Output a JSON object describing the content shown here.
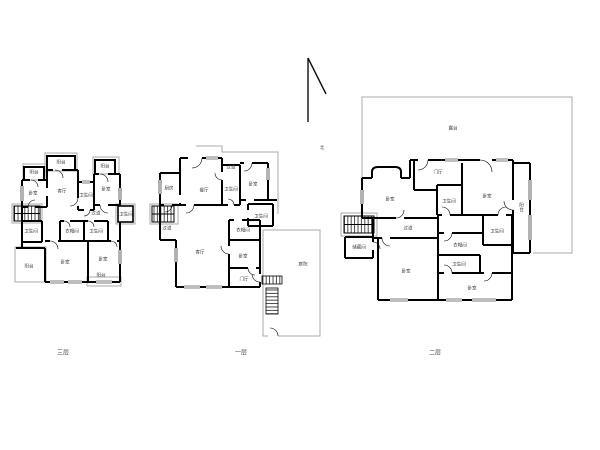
{
  "colors": {
    "wall": "#000000",
    "outline": "#a9a9a9",
    "label": "#3c3c3c",
    "background": "#ffffff"
  },
  "north": {
    "label": "北"
  },
  "plans": [
    {
      "name": "third-floor",
      "caption": "三层",
      "rooms": [
        {
          "label": "阳台",
          "x": 34,
          "y": 172
        },
        {
          "label": "阳台",
          "x": 61,
          "y": 162
        },
        {
          "label": "阳台",
          "x": 105,
          "y": 166
        },
        {
          "label": "卧室",
          "x": 33,
          "y": 193
        },
        {
          "label": "客厅",
          "x": 62,
          "y": 191
        },
        {
          "label": "卫生间",
          "x": 86,
          "y": 195
        },
        {
          "label": "卧室",
          "x": 106,
          "y": 189
        },
        {
          "label": "过道",
          "x": 96,
          "y": 213
        },
        {
          "label": "卫生间",
          "x": 126,
          "y": 214
        },
        {
          "label": "卫生间",
          "x": 31,
          "y": 231
        },
        {
          "label": "衣帽间",
          "x": 72,
          "y": 231
        },
        {
          "label": "卫生间",
          "x": 96,
          "y": 231
        },
        {
          "label": "卧室",
          "x": 65,
          "y": 262
        },
        {
          "label": "卧室",
          "x": 103,
          "y": 259
        },
        {
          "label": "阳台",
          "x": 29,
          "y": 266
        },
        {
          "label": "阳台",
          "x": 101,
          "y": 275
        }
      ]
    },
    {
      "name": "first-floor",
      "caption": "一层",
      "rooms": [
        {
          "label": "厨房",
          "x": 169,
          "y": 188
        },
        {
          "label": "餐厅",
          "x": 204,
          "y": 190
        },
        {
          "label": "过道",
          "x": 231,
          "y": 167
        },
        {
          "label": "卫生间",
          "x": 231,
          "y": 189
        },
        {
          "label": "卧室",
          "x": 253,
          "y": 184
        },
        {
          "label": "卫生间",
          "x": 261,
          "y": 216
        },
        {
          "label": "衣帽间",
          "x": 243,
          "y": 230
        },
        {
          "label": "过道",
          "x": 167,
          "y": 228
        },
        {
          "label": "客厅",
          "x": 200,
          "y": 252
        },
        {
          "label": "卧室",
          "x": 243,
          "y": 256
        },
        {
          "label": "门厅",
          "x": 244,
          "y": 279
        },
        {
          "label": "庭院",
          "x": 303,
          "y": 264
        }
      ]
    },
    {
      "name": "second-floor",
      "caption": "二层",
      "rooms": [
        {
          "label": "露台",
          "x": 453,
          "y": 128
        },
        {
          "label": "卧室",
          "x": 390,
          "y": 199
        },
        {
          "label": "门厅",
          "x": 438,
          "y": 172
        },
        {
          "label": "卫生间",
          "x": 449,
          "y": 201
        },
        {
          "label": "卧室",
          "x": 487,
          "y": 196
        },
        {
          "label": "阳台",
          "x": 521,
          "y": 207,
          "v": true
        },
        {
          "label": "储藏间",
          "x": 359,
          "y": 247
        },
        {
          "label": "过道",
          "x": 408,
          "y": 228
        },
        {
          "label": "衣帽间",
          "x": 460,
          "y": 245
        },
        {
          "label": "卫生间",
          "x": 497,
          "y": 231
        },
        {
          "label": "卫生间",
          "x": 459,
          "y": 264
        },
        {
          "label": "卧室",
          "x": 406,
          "y": 271
        },
        {
          "label": "卧室",
          "x": 472,
          "y": 288
        }
      ]
    }
  ]
}
